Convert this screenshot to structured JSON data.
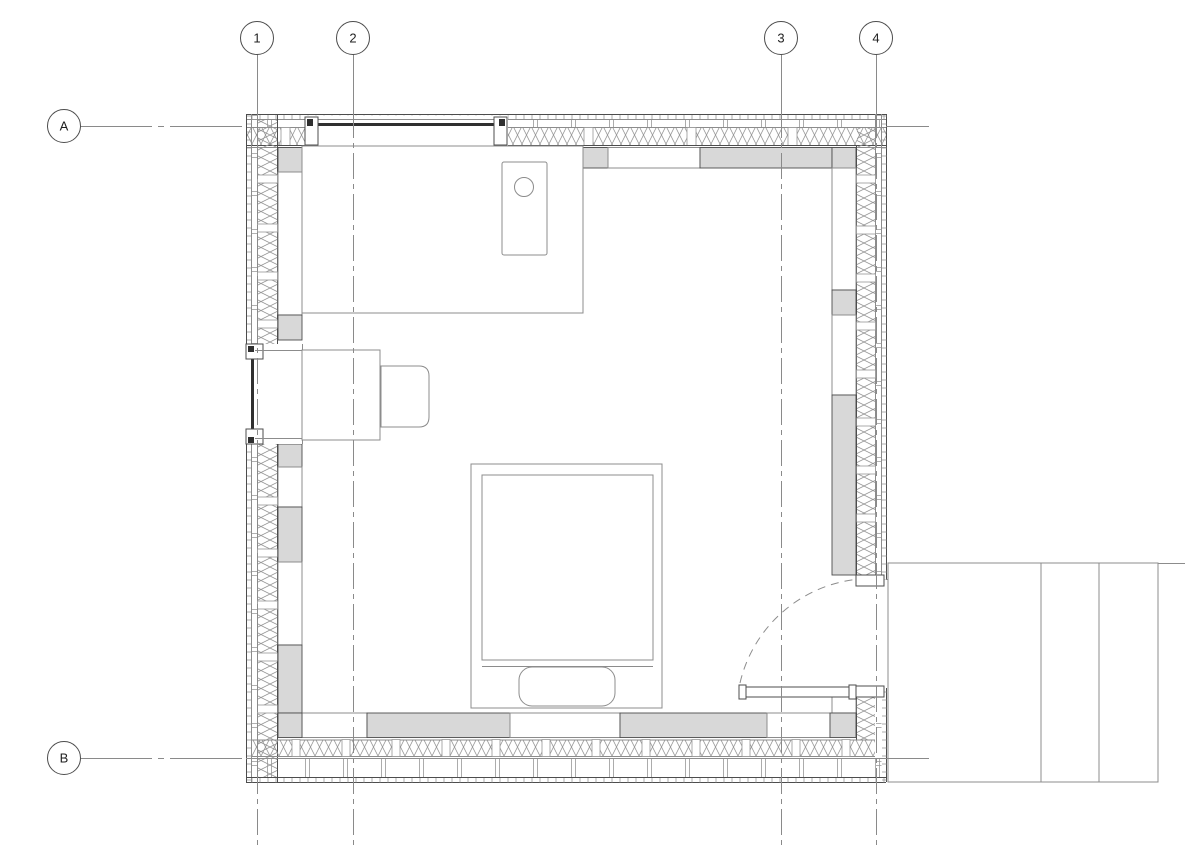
{
  "title": "cabin-floor-plan-drawing",
  "colors": {
    "bg": "#ffffff",
    "line": "#4d4d4d",
    "light": "#8c8c8c",
    "gray": "#d8d8d8",
    "hatch": "#979797",
    "grid": "#8a8a8a",
    "glazing": "#303030",
    "label": "#1f1f1f"
  },
  "grid": {
    "columns": [
      {
        "label": "1",
        "x": 257
      },
      {
        "label": "2",
        "x": 353
      },
      {
        "label": "3",
        "x": 781
      },
      {
        "label": "4",
        "x": 876
      }
    ],
    "rows": [
      {
        "label": "A",
        "y": 126
      },
      {
        "label": "B",
        "y": 758
      }
    ]
  },
  "plan_items": {
    "kitchen_counter": "kitchen-counter",
    "sink": "sink-with-drain",
    "desk": "desk",
    "chair": "chair",
    "bed": "bed-with-pillow",
    "door": "double-swing-entry-door",
    "deck": "exterior-deck",
    "window_top": "window-north-wall",
    "window_left": "window-west-wall"
  }
}
